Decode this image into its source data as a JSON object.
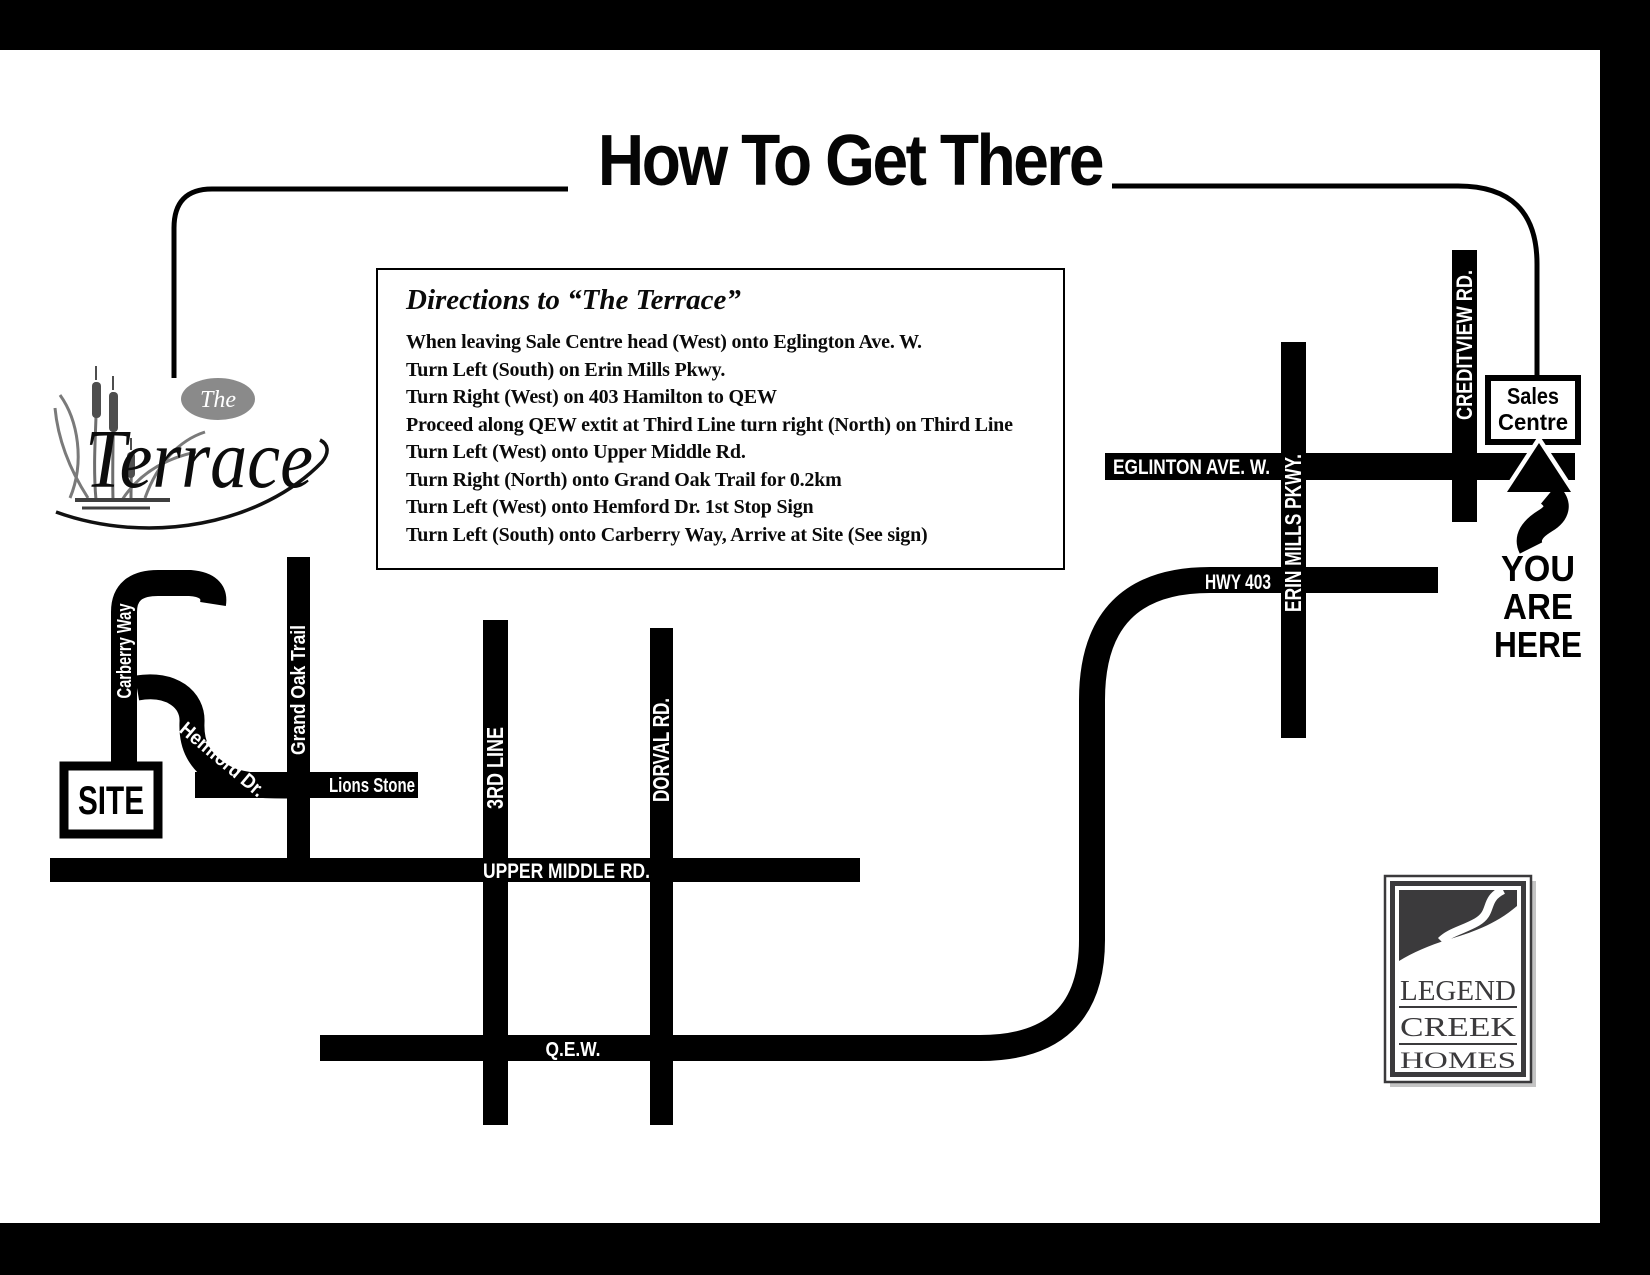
{
  "header": {
    "title": "How To Get There"
  },
  "terrace_logo": {
    "the": "The",
    "name": "Terrace"
  },
  "directions_box": {
    "title": "Directions to “The Terrace”",
    "lines": [
      "When leaving Sale Centre head (West) onto Eglington Ave. W.",
      "Turn Left (South) on Erin Mills Pkwy.",
      "Turn Right (West) on 403 Hamilton to QEW",
      "Proceed along QEW extit at Third Line turn right (North) on Third Line",
      "Turn Left (West) onto Upper Middle Rd.",
      "Turn Right (North) onto Grand Oak Trail for 0.2km",
      "Turn Left (West) onto Hemford Dr. 1st Stop Sign",
      "Turn Left (South) onto Carberry Way, Arrive at Site (See sign)"
    ]
  },
  "map": {
    "site_label": "SITE",
    "sales_centre": {
      "line1": "Sales",
      "line2": "Centre"
    },
    "you_are_here": {
      "line1": "YOU",
      "line2": "ARE",
      "line3": "HERE"
    },
    "road_labels": {
      "carberry_way": "Carberry Way",
      "hemford_dr": "Hemford Dr.",
      "grand_oak_trail": "Grand Oak Trail",
      "lions_stone": "Lions Stone",
      "third_line": "3RD LINE",
      "dorval_rd": "DORVAL RD.",
      "upper_middle_rd": "UPPER MIDDLE RD.",
      "qew": "Q.E.W.",
      "eglinton_ave_w": "EGLINTON AVE. W.",
      "erin_mills_pkwy": "ERIN MILLS PKWY.",
      "creditview_rd": "CREDITVIEW RD.",
      "hwy_403": "HWY 403"
    }
  },
  "builder_logo": {
    "line1": "LEGEND",
    "line2": "CREEK",
    "line3": "HOMES"
  },
  "colors": {
    "road": "#000000",
    "road_label": "#ffffff",
    "logo_charcoal": "#3b3a3c",
    "logo_oval_gray": "#8a8a8a"
  }
}
